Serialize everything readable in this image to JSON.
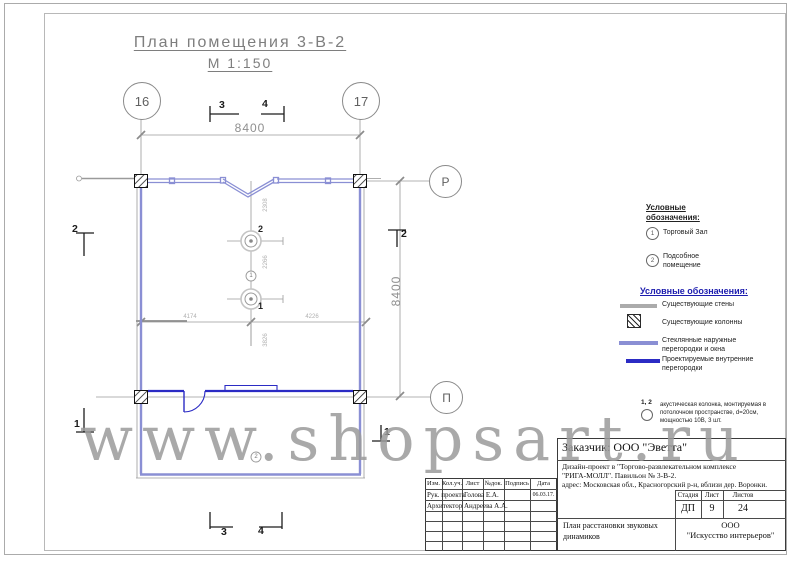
{
  "title": {
    "name": "План помещения 3-В-2",
    "scale": "М 1:150"
  },
  "axes": {
    "col_left": "16",
    "col_right": "17",
    "row_top": "Р",
    "row_bottom": "П"
  },
  "dims": {
    "top": "8400",
    "right": "8400",
    "inner_h_left": "4174",
    "inner_h_right": "4226",
    "inner_v_1": "2308",
    "inner_v_2": "2266",
    "inner_v_3": "3826"
  },
  "sections": {
    "top_3": "3",
    "top_4": "4",
    "bottom_3": "3",
    "bottom_4": "4",
    "left_2": "2",
    "left_1": "1",
    "right_2": "2",
    "right_1": "1"
  },
  "plan_labels": {
    "speaker_2": "2",
    "speaker_1": "1",
    "room_1": "1",
    "room_2": "2"
  },
  "legend_rooms": {
    "header": "Условные обозначения:",
    "items": [
      {
        "num": "1",
        "label": "Торговый Зал"
      },
      {
        "num": "2",
        "label": "Подсобное помещение"
      }
    ]
  },
  "legend_walls": {
    "header": "Условные обозначения:",
    "items": [
      {
        "label": "Существующие стены"
      },
      {
        "label": "Существующие колонны"
      },
      {
        "label": "Стеклянные наружные перегородки и окна"
      },
      {
        "label": "Проектируемые внутренние перегородки"
      }
    ]
  },
  "note": {
    "nums": "1, 2",
    "text": "акустическая колонка, монтируемая в потолочном пространстве, d=20см, мощностью 10В, 3 шт."
  },
  "titleblock": {
    "client": "Заказчик:  ООО \"Эветта\"",
    "project_line1": "Дизайн-проект в  \"Торгово-развлекательном комплексе",
    "project_line2": "\"РИГА-МОЛЛ\". Павильон № 3-В-2.",
    "project_line3": "адрес: Московская обл., Красногорский р-н, вблизи дер. Воронки.",
    "cols": {
      "izm": "Изм.",
      "koluch": "Кол.уч.",
      "list": "Лист",
      "ndok": "№док.",
      "podpis": "Подпись",
      "data": "Дата"
    },
    "rows": [
      {
        "role": "Рук. проекта",
        "name": "Голова Е.А.",
        "date": "06.03.17."
      },
      {
        "role": "Архитектор",
        "name": "Андреева А.А.",
        "date": ""
      }
    ],
    "stage_label": "Стадия",
    "sheet_label": "Лист",
    "sheets_label": "Листов",
    "stage": "ДП",
    "sheet": "9",
    "sheets": "24",
    "doc_title": "План расстановки звуковых динамиков",
    "company_line1": "ООО",
    "company_line2": "\"Искусство интерьеров\""
  },
  "watermark": "www.shopsart.ru",
  "colors": {
    "storefront": "#8a8fd4",
    "partition": "#2b2bc4",
    "existing": "#9a9a9a",
    "legend_header": "#1c1cae"
  }
}
